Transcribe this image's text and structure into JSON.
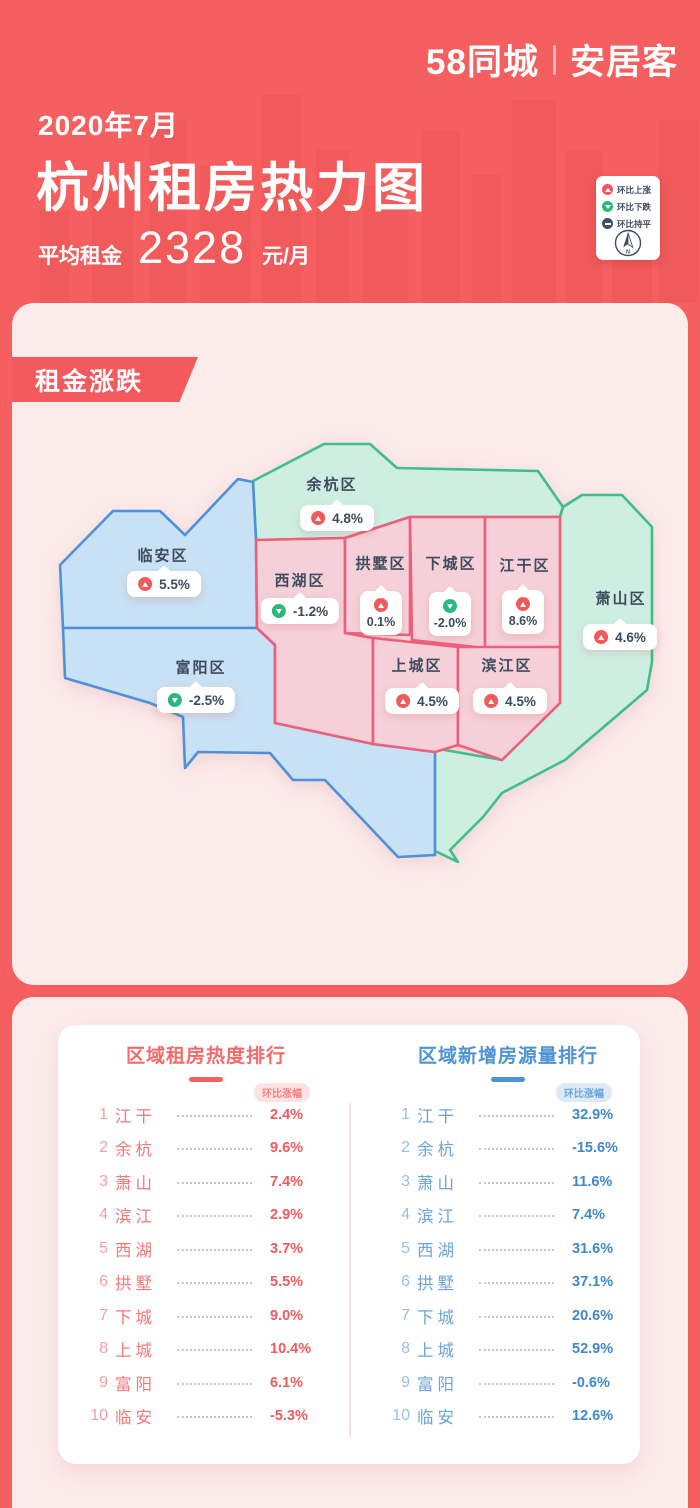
{
  "brand": {
    "logo_left": "58同城",
    "logo_right": "安居客"
  },
  "header": {
    "date": "2020年7月",
    "title": "杭州租房热力图",
    "avg_label": "平均租金",
    "avg_value": "2328",
    "avg_unit": "元/月"
  },
  "legend": {
    "items": [
      {
        "icon": "up",
        "label": "环比上涨"
      },
      {
        "icon": "down",
        "label": "环比下跌"
      },
      {
        "icon": "flat",
        "label": "环比持平"
      }
    ],
    "compass_label": "N"
  },
  "map_section": {
    "ribbon": "租金涨跌",
    "regions": [
      {
        "id": "yuhang",
        "name": "余杭区",
        "value": "4.8%",
        "trend": "up",
        "badge": "h"
      },
      {
        "id": "linan",
        "name": "临安区",
        "value": "5.5%",
        "trend": "up",
        "badge": "h"
      },
      {
        "id": "xihu",
        "name": "西湖区",
        "value": "-1.2%",
        "trend": "down",
        "badge": "h"
      },
      {
        "id": "gongshu",
        "name": "拱墅区",
        "value": "0.1%",
        "trend": "up",
        "badge": "v"
      },
      {
        "id": "xiacheng",
        "name": "下城区",
        "value": "-2.0%",
        "trend": "down",
        "badge": "v"
      },
      {
        "id": "jianggan",
        "name": "江干区",
        "value": "8.6%",
        "trend": "up",
        "badge": "v"
      },
      {
        "id": "xiaoshan",
        "name": "萧山区",
        "value": "4.6%",
        "trend": "up",
        "badge": "h"
      },
      {
        "id": "fuyang",
        "name": "富阳区",
        "value": "-2.5%",
        "trend": "down",
        "badge": "h"
      },
      {
        "id": "shangcheng",
        "name": "上城区",
        "value": "4.5%",
        "trend": "up",
        "badge": "h"
      },
      {
        "id": "binjiang",
        "name": "滨江区",
        "value": "4.5%",
        "trend": "up",
        "badge": "h"
      }
    ]
  },
  "rankings": [
    {
      "id": "heat",
      "title": "区域租房热度排行",
      "subtitle": "环比涨幅",
      "accent": "#f56a6a",
      "rows": [
        {
          "rank": "1",
          "name": "江干",
          "value": "2.4%"
        },
        {
          "rank": "2",
          "name": "余杭",
          "value": "9.6%"
        },
        {
          "rank": "3",
          "name": "萧山",
          "value": "7.4%"
        },
        {
          "rank": "4",
          "name": "滨江",
          "value": "2.9%"
        },
        {
          "rank": "5",
          "name": "西湖",
          "value": "3.7%"
        },
        {
          "rank": "6",
          "name": "拱墅",
          "value": "5.5%"
        },
        {
          "rank": "7",
          "name": "下城",
          "value": "9.0%"
        },
        {
          "rank": "8",
          "name": "上城",
          "value": "10.4%"
        },
        {
          "rank": "9",
          "name": "富阳",
          "value": "6.1%"
        },
        {
          "rank": "10",
          "name": "临安",
          "value": "-5.3%"
        }
      ]
    },
    {
      "id": "supply",
      "title": "区域新增房源量排行",
      "subtitle": "环比涨幅",
      "accent": "#4e93d3",
      "rows": [
        {
          "rank": "1",
          "name": "江干",
          "value": "32.9%"
        },
        {
          "rank": "2",
          "name": "余杭",
          "value": "-15.6%"
        },
        {
          "rank": "3",
          "name": "萧山",
          "value": "11.6%"
        },
        {
          "rank": "4",
          "name": "滨江",
          "value": "7.4%"
        },
        {
          "rank": "5",
          "name": "西湖",
          "value": "31.6%"
        },
        {
          "rank": "6",
          "name": "拱墅",
          "value": "37.1%"
        },
        {
          "rank": "7",
          "name": "下城",
          "value": "20.6%"
        },
        {
          "rank": "8",
          "name": "上城",
          "value": "52.9%"
        },
        {
          "rank": "9",
          "name": "富阳",
          "value": "-0.6%"
        },
        {
          "rank": "10",
          "name": "临安",
          "value": "12.6%"
        }
      ]
    }
  ],
  "colors": {
    "background": "#f65f5f",
    "panel": "#fcebeb",
    "up": "#f15a5d",
    "down": "#2cb87d",
    "flat": "#3c5068",
    "map_pink": "#f6d0d8",
    "map_blue": "#c9e1f4",
    "map_green": "#ceeee2",
    "heat_accent": "#f56a6a",
    "supply_accent": "#4e93d3"
  }
}
